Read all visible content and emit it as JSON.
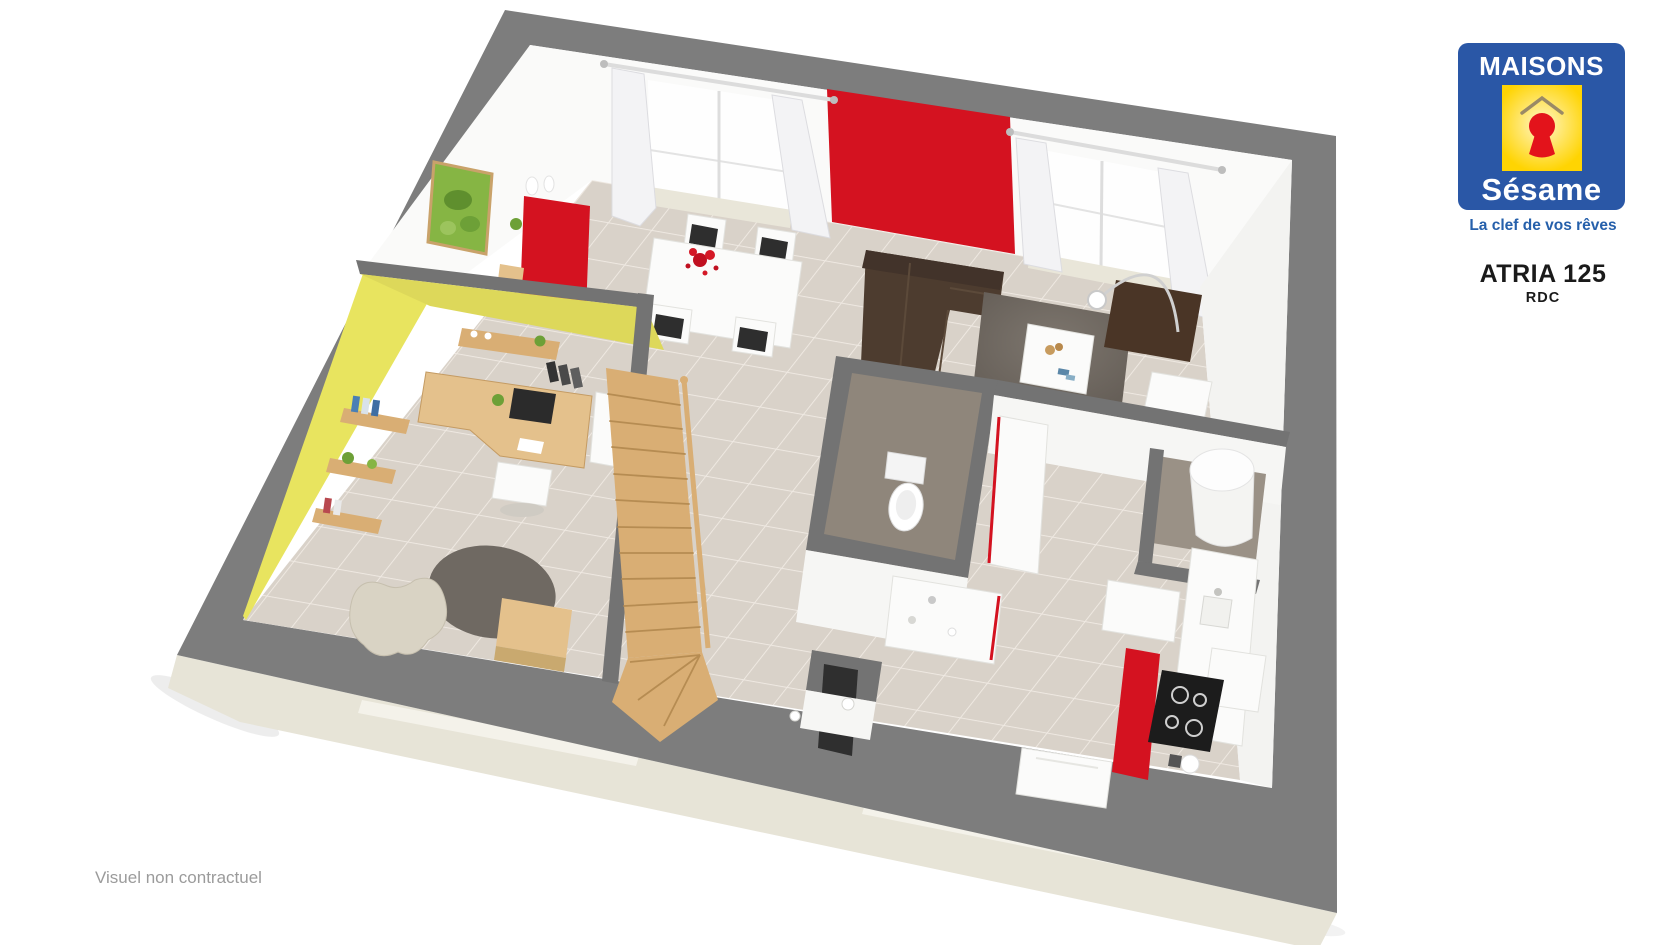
{
  "branding": {
    "logo_line1": "MAISONS",
    "logo_line2": "Sésame",
    "tagline": "La clef de vos rêves"
  },
  "plan": {
    "title": "ATRIA 125",
    "level": "RDC",
    "disclaimer": "Visuel non contractuel"
  },
  "colors": {
    "brand_blue": "#2a57a6",
    "brand_yellow": "#ffd402",
    "brand_yellow_light": "#fff6c8",
    "brand_red": "#e3131b",
    "tagline_blue": "#2660ab",
    "title_black": "#1a1a1a",
    "disclaimer_gray": "#9b9b9b",
    "wall_cap_gray": "#7d7d7d",
    "wall_cap_dark": "#737373",
    "outer_face_cream": "#e7e4d7",
    "floor_tile": "#d9d2c9",
    "floor_grout": "#efe9e2",
    "accent_red": "#d41220",
    "office_yellow": "#e8e45f",
    "office_yellow_dark": "#ddd85a",
    "wood": "#d9ae74",
    "wood_light": "#e4c18c",
    "sofa_brown": "#4d3c2f",
    "desk_brown": "#4a3526",
    "rug_gray": "#6f6962",
    "wc_floor": "#8f867b"
  }
}
